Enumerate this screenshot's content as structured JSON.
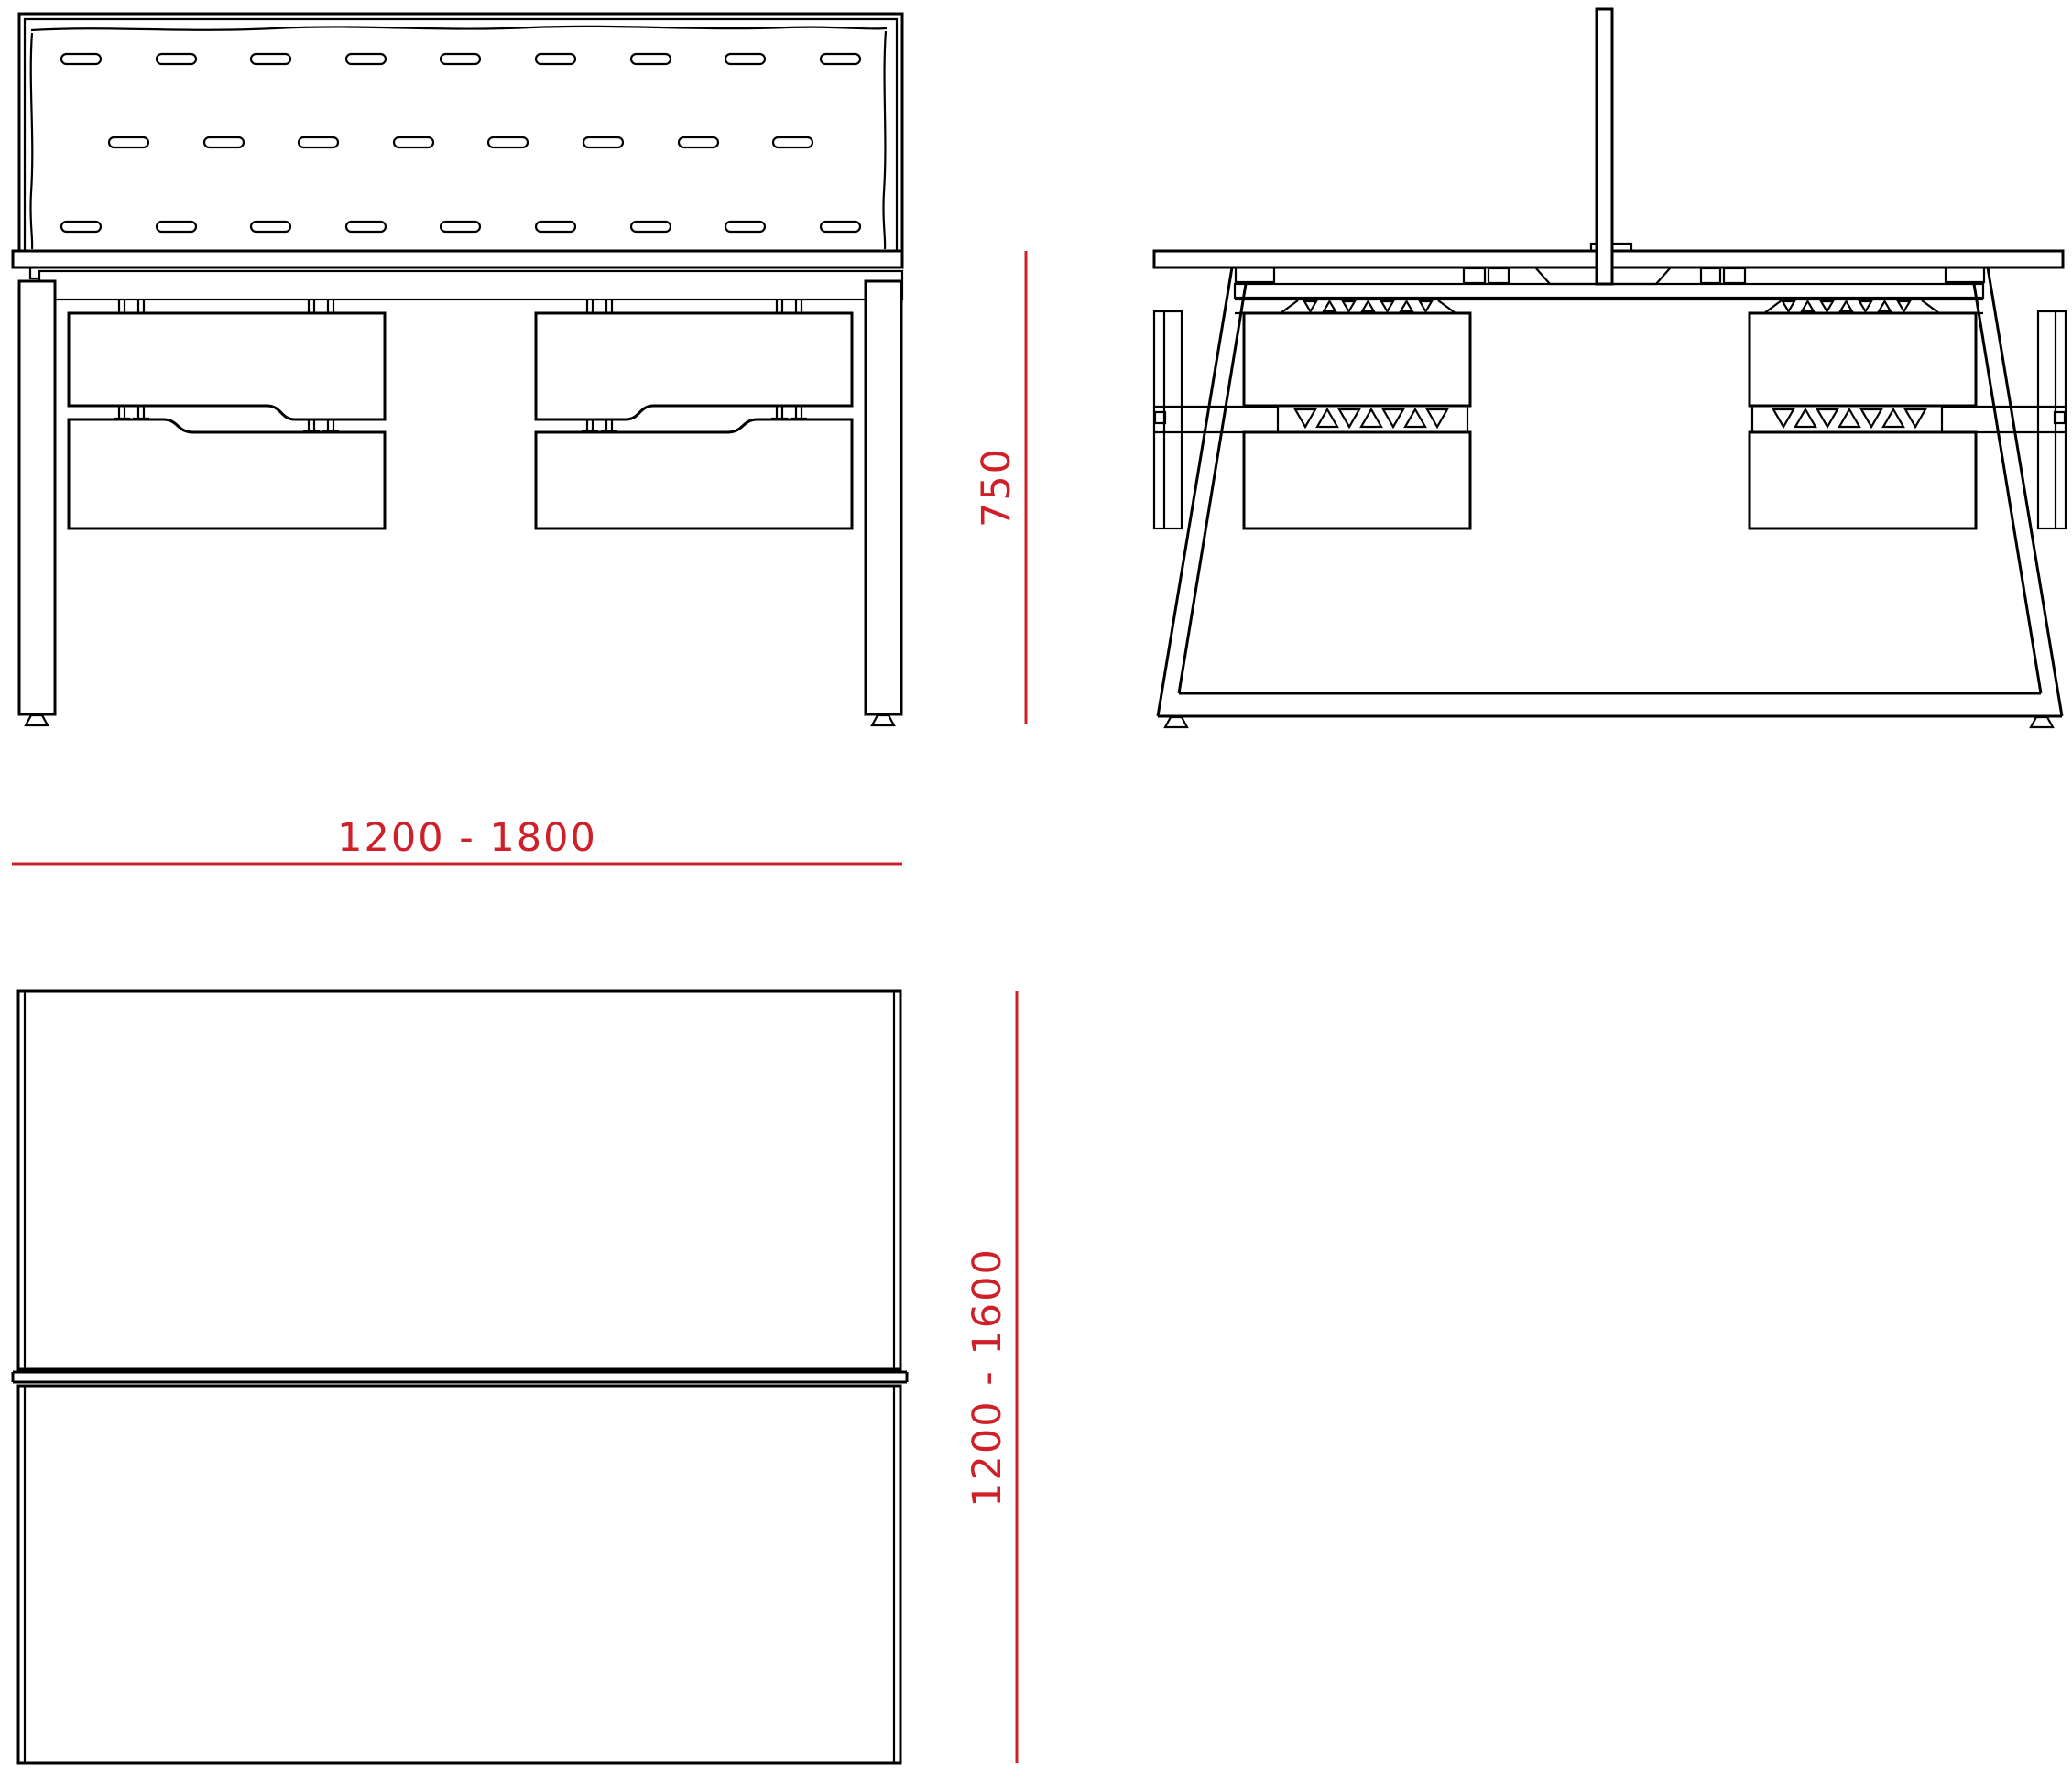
{
  "colors": {
    "outline": "#000000",
    "dimension_red": "#cf202a",
    "background": "#ffffff"
  },
  "dimensions": {
    "width": "1200 - 1800",
    "height": "750",
    "depth": "1200 - 1600"
  }
}
